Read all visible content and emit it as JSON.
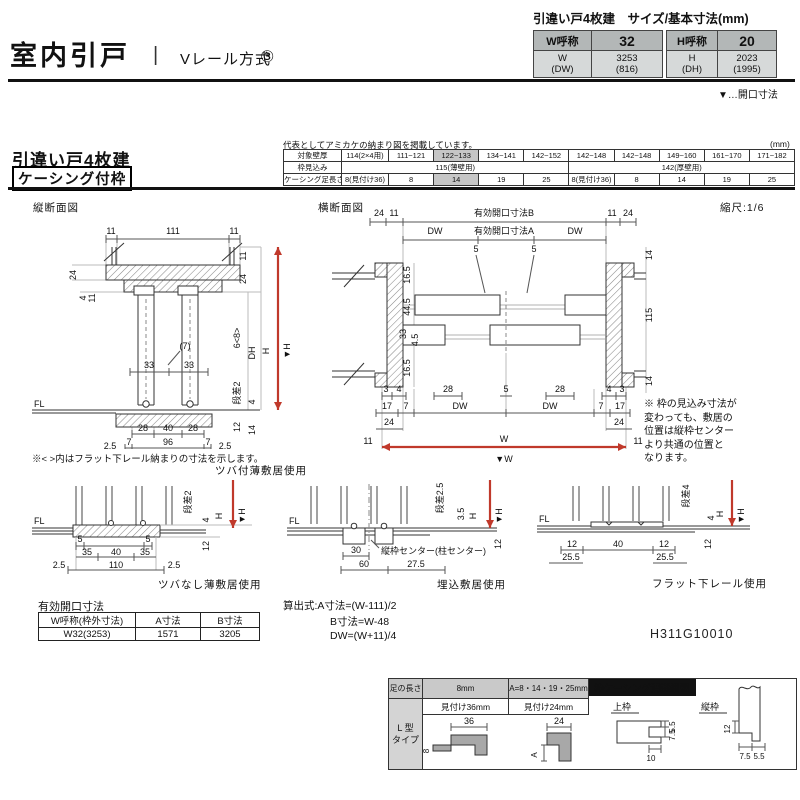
{
  "colors": {
    "accent_red": "#c0392b",
    "table_header_gray": "#b3b7b7",
    "table_subrow_gray": "#d6d9d9",
    "shaded_cell_gray": "#c6c6c6",
    "panel_header_black": "#111111"
  },
  "header": {
    "title": "室内引戸",
    "separator": "|",
    "method": "Vレール方式",
    "method_number": "③",
    "size_title": "引違い戸4枚建　サイズ/基本寸法(mm)",
    "w_table": {
      "label": "W呼称",
      "value": "32",
      "sub_label1": "W",
      "sub_label2": "(DW)",
      "sub_value1": "3253",
      "sub_value2": "(816)"
    },
    "h_table": {
      "label": "H呼称",
      "value": "20",
      "sub_label1": "H",
      "sub_label2": "(DH)",
      "sub_value1": "2023",
      "sub_value2": "(1995)"
    },
    "opening_note": "▼…開口寸法"
  },
  "frame": {
    "heading": "引違い戸4枚建",
    "subheading": "ケーシング付枠",
    "rep_note": "代表としてアミカケの納まり図を掲載しています。",
    "unit": "(mm)",
    "row1_label": "対象壁厚",
    "row1": [
      "114(2×4用)",
      "111~121",
      "122~133",
      "134~141",
      "142~152",
      "142~148",
      "142~148",
      "149~160",
      "161~170",
      "171~182"
    ],
    "row2_label": "枠見込み",
    "row2_g1": "115(薄壁用)",
    "row2_g2": "142(厚壁用)",
    "row3_label": "ケーシング足長さ",
    "row3": [
      "8(見付け36)",
      "8",
      "14",
      "19",
      "25",
      "8(見付け36)",
      "8",
      "14",
      "19",
      "25"
    ]
  },
  "vs": {
    "title": "縦断面図",
    "top": [
      "11",
      "111",
      "11"
    ],
    "left": [
      "24",
      "4",
      "11"
    ],
    "right": [
      "11",
      "24",
      "6<8>",
      "DH",
      "H",
      "▼H",
      "段差2",
      "4",
      "12",
      "14"
    ],
    "mid": [
      "(7)",
      "33",
      "33"
    ],
    "b1": [
      "28",
      "40",
      "28"
    ],
    "b2": [
      "7",
      "96",
      "7"
    ],
    "b3": [
      "2.5",
      "2.5"
    ],
    "fl": "FL",
    "note": "※< >内はフラット下レール納まりの寸法を示します。",
    "caption": "ツバ付薄敷居使用"
  },
  "hs": {
    "title": "横断面図",
    "scale": "縮尺:1/6",
    "tl": [
      "24",
      "11"
    ],
    "tr": [
      "11",
      "24"
    ],
    "openB": "有効開口寸法B",
    "openA": "有効開口寸法A",
    "dwL": "DW",
    "dwR": "DW",
    "five": [
      "5",
      "5",
      "5"
    ],
    "left": [
      "16.5",
      "44.5",
      "33",
      "4.5",
      "16.5"
    ],
    "right": [
      "14",
      "115",
      "14"
    ],
    "b1": [
      "3",
      "4",
      "28",
      "28",
      "4",
      "3"
    ],
    "b2": [
      "17",
      "7",
      "DW",
      "DW",
      "7",
      "17"
    ],
    "b3": [
      "24",
      "24"
    ],
    "b4": [
      "11",
      "W",
      "11"
    ],
    "b5": "▼W",
    "note": [
      "※ 枠の見込み寸法が",
      "変わっても、敷居の",
      "位置は縦枠センター",
      "より共通の位置と",
      "なります。"
    ]
  },
  "d1": {
    "caption": "ツバなし薄敷居使用",
    "fl": "FL",
    "r": [
      "段差2",
      "4",
      "H",
      "▼H",
      "12"
    ],
    "a": [
      "5",
      "5"
    ],
    "b": [
      "35",
      "40",
      "35"
    ],
    "c": [
      "2.5",
      "110",
      "2.5"
    ]
  },
  "d2": {
    "caption": "埋込敷居使用",
    "fl": "FL",
    "center": "縦枠センター(柱センター)",
    "a": [
      "30",
      "60",
      "27.5"
    ],
    "r": [
      "段差2.5",
      "3.5",
      "H",
      "▼H",
      "12"
    ]
  },
  "d3": {
    "caption": "フラット下レール使用",
    "fl": "FL",
    "a": [
      "12",
      "40",
      "12"
    ],
    "b": [
      "25.5",
      "25.5"
    ],
    "r": [
      "段差4",
      "4",
      "H",
      "▼H",
      "12"
    ]
  },
  "open_tbl": {
    "title": "有効開口寸法",
    "h": [
      "W呼称(枠外寸法)",
      "A寸法",
      "B寸法"
    ],
    "r": [
      "W32(3253)",
      "1571",
      "3205"
    ]
  },
  "formulas": [
    "算出式:A寸法=(W-111)/2",
    "B寸法=W-48",
    "DW=(W+11)/4"
  ],
  "code": "H311G10010",
  "panel": {
    "col1_header": "足の長さ",
    "type1": "L 型",
    "type2": "タイプ",
    "col2_header": "8mm",
    "col2_sub": "見付け36mm",
    "col2_dim_w": "36",
    "col2_dim_h": "8",
    "col3_header": "A=8・14・19・25mm",
    "col3_sub": "見付け24mm",
    "col3_dim_w": "24",
    "col3_dim_h": "A",
    "detail_title": "枠ケーシング溝詳細図",
    "upper_label": "上枠",
    "upper_d1": "5.5",
    "upper_d2": "7.5",
    "upper_d3": "10",
    "side_label": "縦枠",
    "side_d1": "12",
    "side_d2": "7.5",
    "side_d3": "5.5"
  }
}
